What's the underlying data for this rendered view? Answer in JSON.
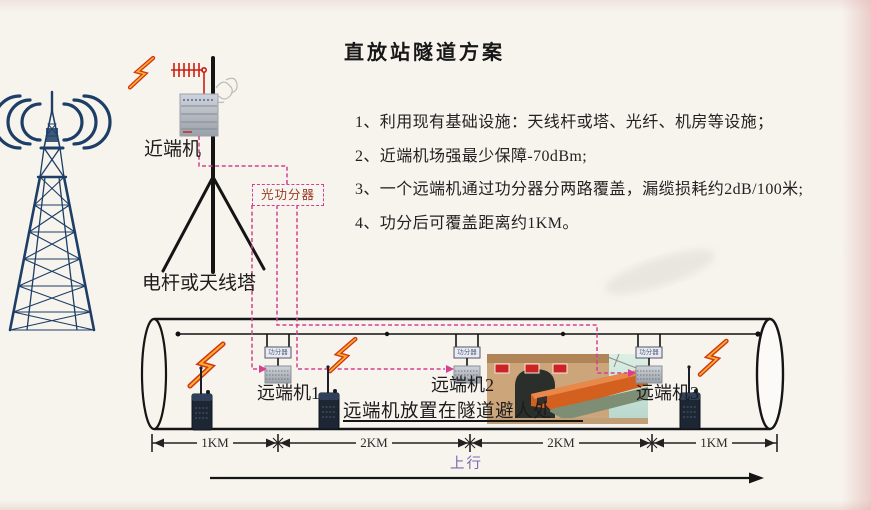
{
  "title": "直放站隧道方案",
  "notes": [
    "1、利用现有基础设施：天线杆或塔、光纤、机房等设施；",
    "2、近端机场强最少保障-70dBm;",
    "3、一个远端机通过功分器分两路覆盖，漏缆损耗约2dB/100米;",
    "4、功分后可覆盖距离约1KM。"
  ],
  "labels": {
    "near_end_unit": "近端机",
    "pole_or_tower": "电杆或天线塔",
    "optical_splitter": "光功分器",
    "mini_splitter": "功分器",
    "remote_unit_1": "远端机1",
    "remote_unit_2": "远端机2",
    "remote_unit_3": "远端机3",
    "placement_note": "远端机放置在隧道避人处",
    "uplink": "上行"
  },
  "distances": [
    "1KM",
    "2KM",
    "2KM",
    "1KM"
  ],
  "colors": {
    "paper": "#f7f4ee",
    "fiber_magenta": "#d6408f",
    "splitter_text": "#9a3b22",
    "tower_blue": "#1d3e66",
    "uplink_purple": "#7a68b0",
    "bolt_red": "#d43315",
    "bolt_yellow": "#f6b12d",
    "ink": "#1a1a1a"
  }
}
